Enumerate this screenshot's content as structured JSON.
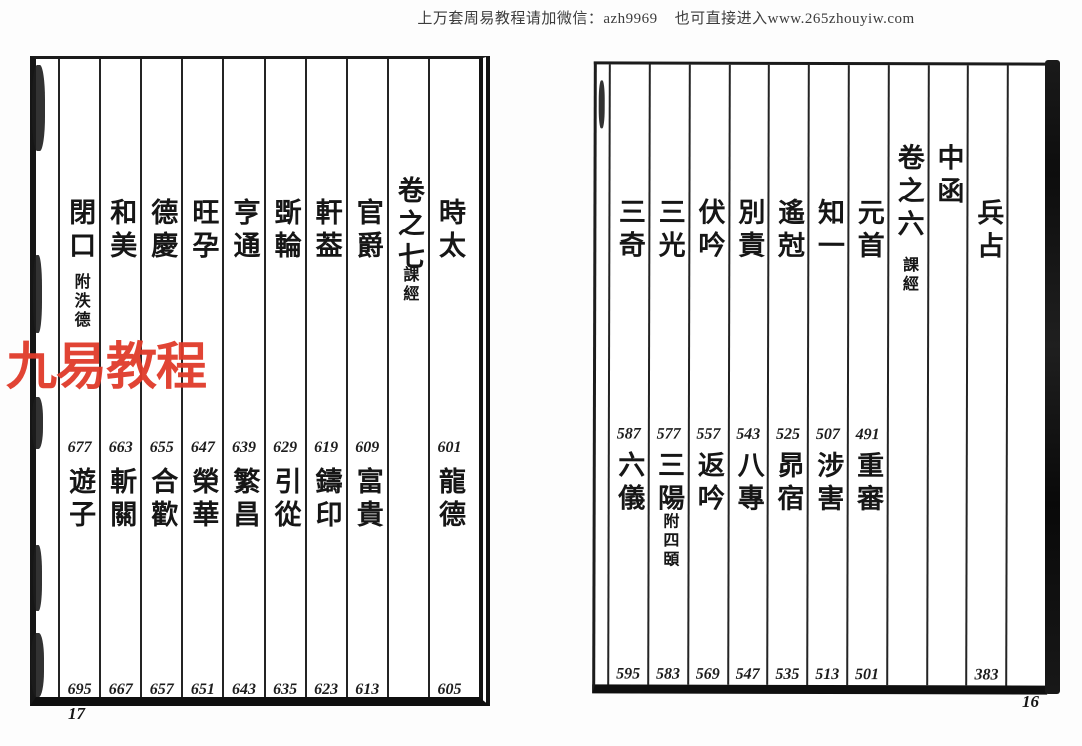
{
  "header": {
    "ad_text": "上万套周易教程请加微信：azh9969    也可直接进入www.265zhouyiw.com"
  },
  "watermark": {
    "text": "九易教程",
    "color": "#e03b2a"
  },
  "ink_color": "#1a1a1a",
  "paper_color": "#ffffff",
  "left_page": {
    "page_number": "17",
    "columns": [
      {
        "top": "時太",
        "mid_num": "601",
        "mid": "龍德",
        "bot_num": "605"
      },
      {
        "top": "卷之七",
        "top_small": "課經",
        "vol": true
      },
      {
        "top": "官爵",
        "mid_num": "609",
        "mid": "富貴",
        "bot_num": "613"
      },
      {
        "top": "軒葢",
        "mid_num": "619",
        "mid": "鑄印",
        "bot_num": "623"
      },
      {
        "top": "斲輪",
        "mid_num": "629",
        "mid": "引從",
        "bot_num": "635"
      },
      {
        "top": "亨通",
        "mid_num": "639",
        "mid": "繁昌",
        "bot_num": "643"
      },
      {
        "top": "旺孕",
        "mid_num": "647",
        "mid": "榮華",
        "bot_num": "651"
      },
      {
        "top": "德慶",
        "mid_num": "655",
        "mid": "合歡",
        "bot_num": "657"
      },
      {
        "top": "和美",
        "mid_num": "663",
        "mid": "斬關",
        "bot_num": "667"
      },
      {
        "top": "閉口",
        "top_small": "附泆德",
        "mid_num": "677",
        "mid": "遊子",
        "bot_num": "695"
      }
    ]
  },
  "right_page": {
    "page_number": "16",
    "columns": [
      {
        "blank": true
      },
      {
        "top": "兵占",
        "bot_num": "383"
      },
      {
        "top": "中函",
        "raised": true
      },
      {
        "top": "卷之六",
        "top_small": "課經",
        "vol": true
      },
      {
        "top": "元首",
        "mid_num": "491",
        "mid": "重審",
        "bot_num": "501"
      },
      {
        "top": "知一",
        "mid_num": "507",
        "mid": "涉害",
        "bot_num": "513"
      },
      {
        "top": "遙尅",
        "mid_num": "525",
        "mid": "昴宿",
        "bot_num": "535"
      },
      {
        "top": "別責",
        "mid_num": "543",
        "mid": "八專",
        "bot_num": "547"
      },
      {
        "top": "伏吟",
        "mid_num": "557",
        "mid": "返吟",
        "bot_num": "569"
      },
      {
        "top": "三光",
        "mid_num": "577",
        "mid": "三陽",
        "mid_small": "附四頣",
        "bot_num": "583"
      },
      {
        "top": "三奇",
        "mid_num": "587",
        "mid": "六儀",
        "bot_num": "595"
      }
    ]
  }
}
